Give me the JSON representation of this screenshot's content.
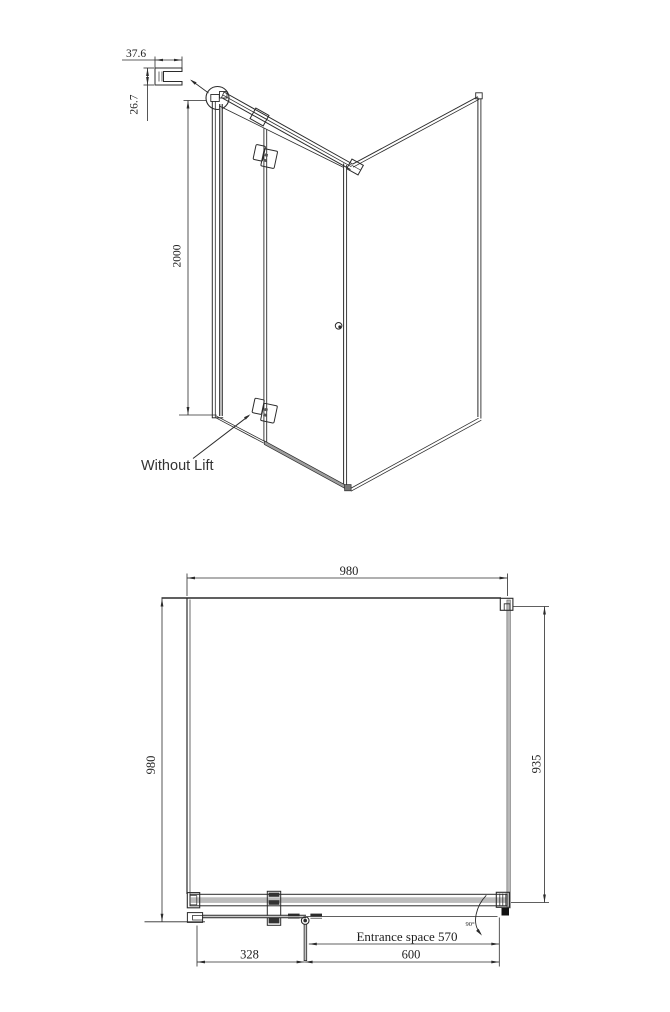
{
  "perspective_view": {
    "profile_detail": {
      "width_dim": "37.6",
      "height_dim": "26.7"
    },
    "height_dim": "2000",
    "note_label": "Without Lift"
  },
  "plan_view": {
    "overall_width_dim": "980",
    "overall_depth_dim": "980",
    "side_panel_dim": "935",
    "entrance_dim_label": "Entrance space 570",
    "fixed_panel_dim": "328",
    "door_dim": "600",
    "door_swing_angle": "90°"
  },
  "colors": {
    "line_color": "#2b2b2b",
    "glass_gray": "#b9b9b9",
    "rail_gray": "#9e9e9e",
    "background": "#ffffff"
  }
}
